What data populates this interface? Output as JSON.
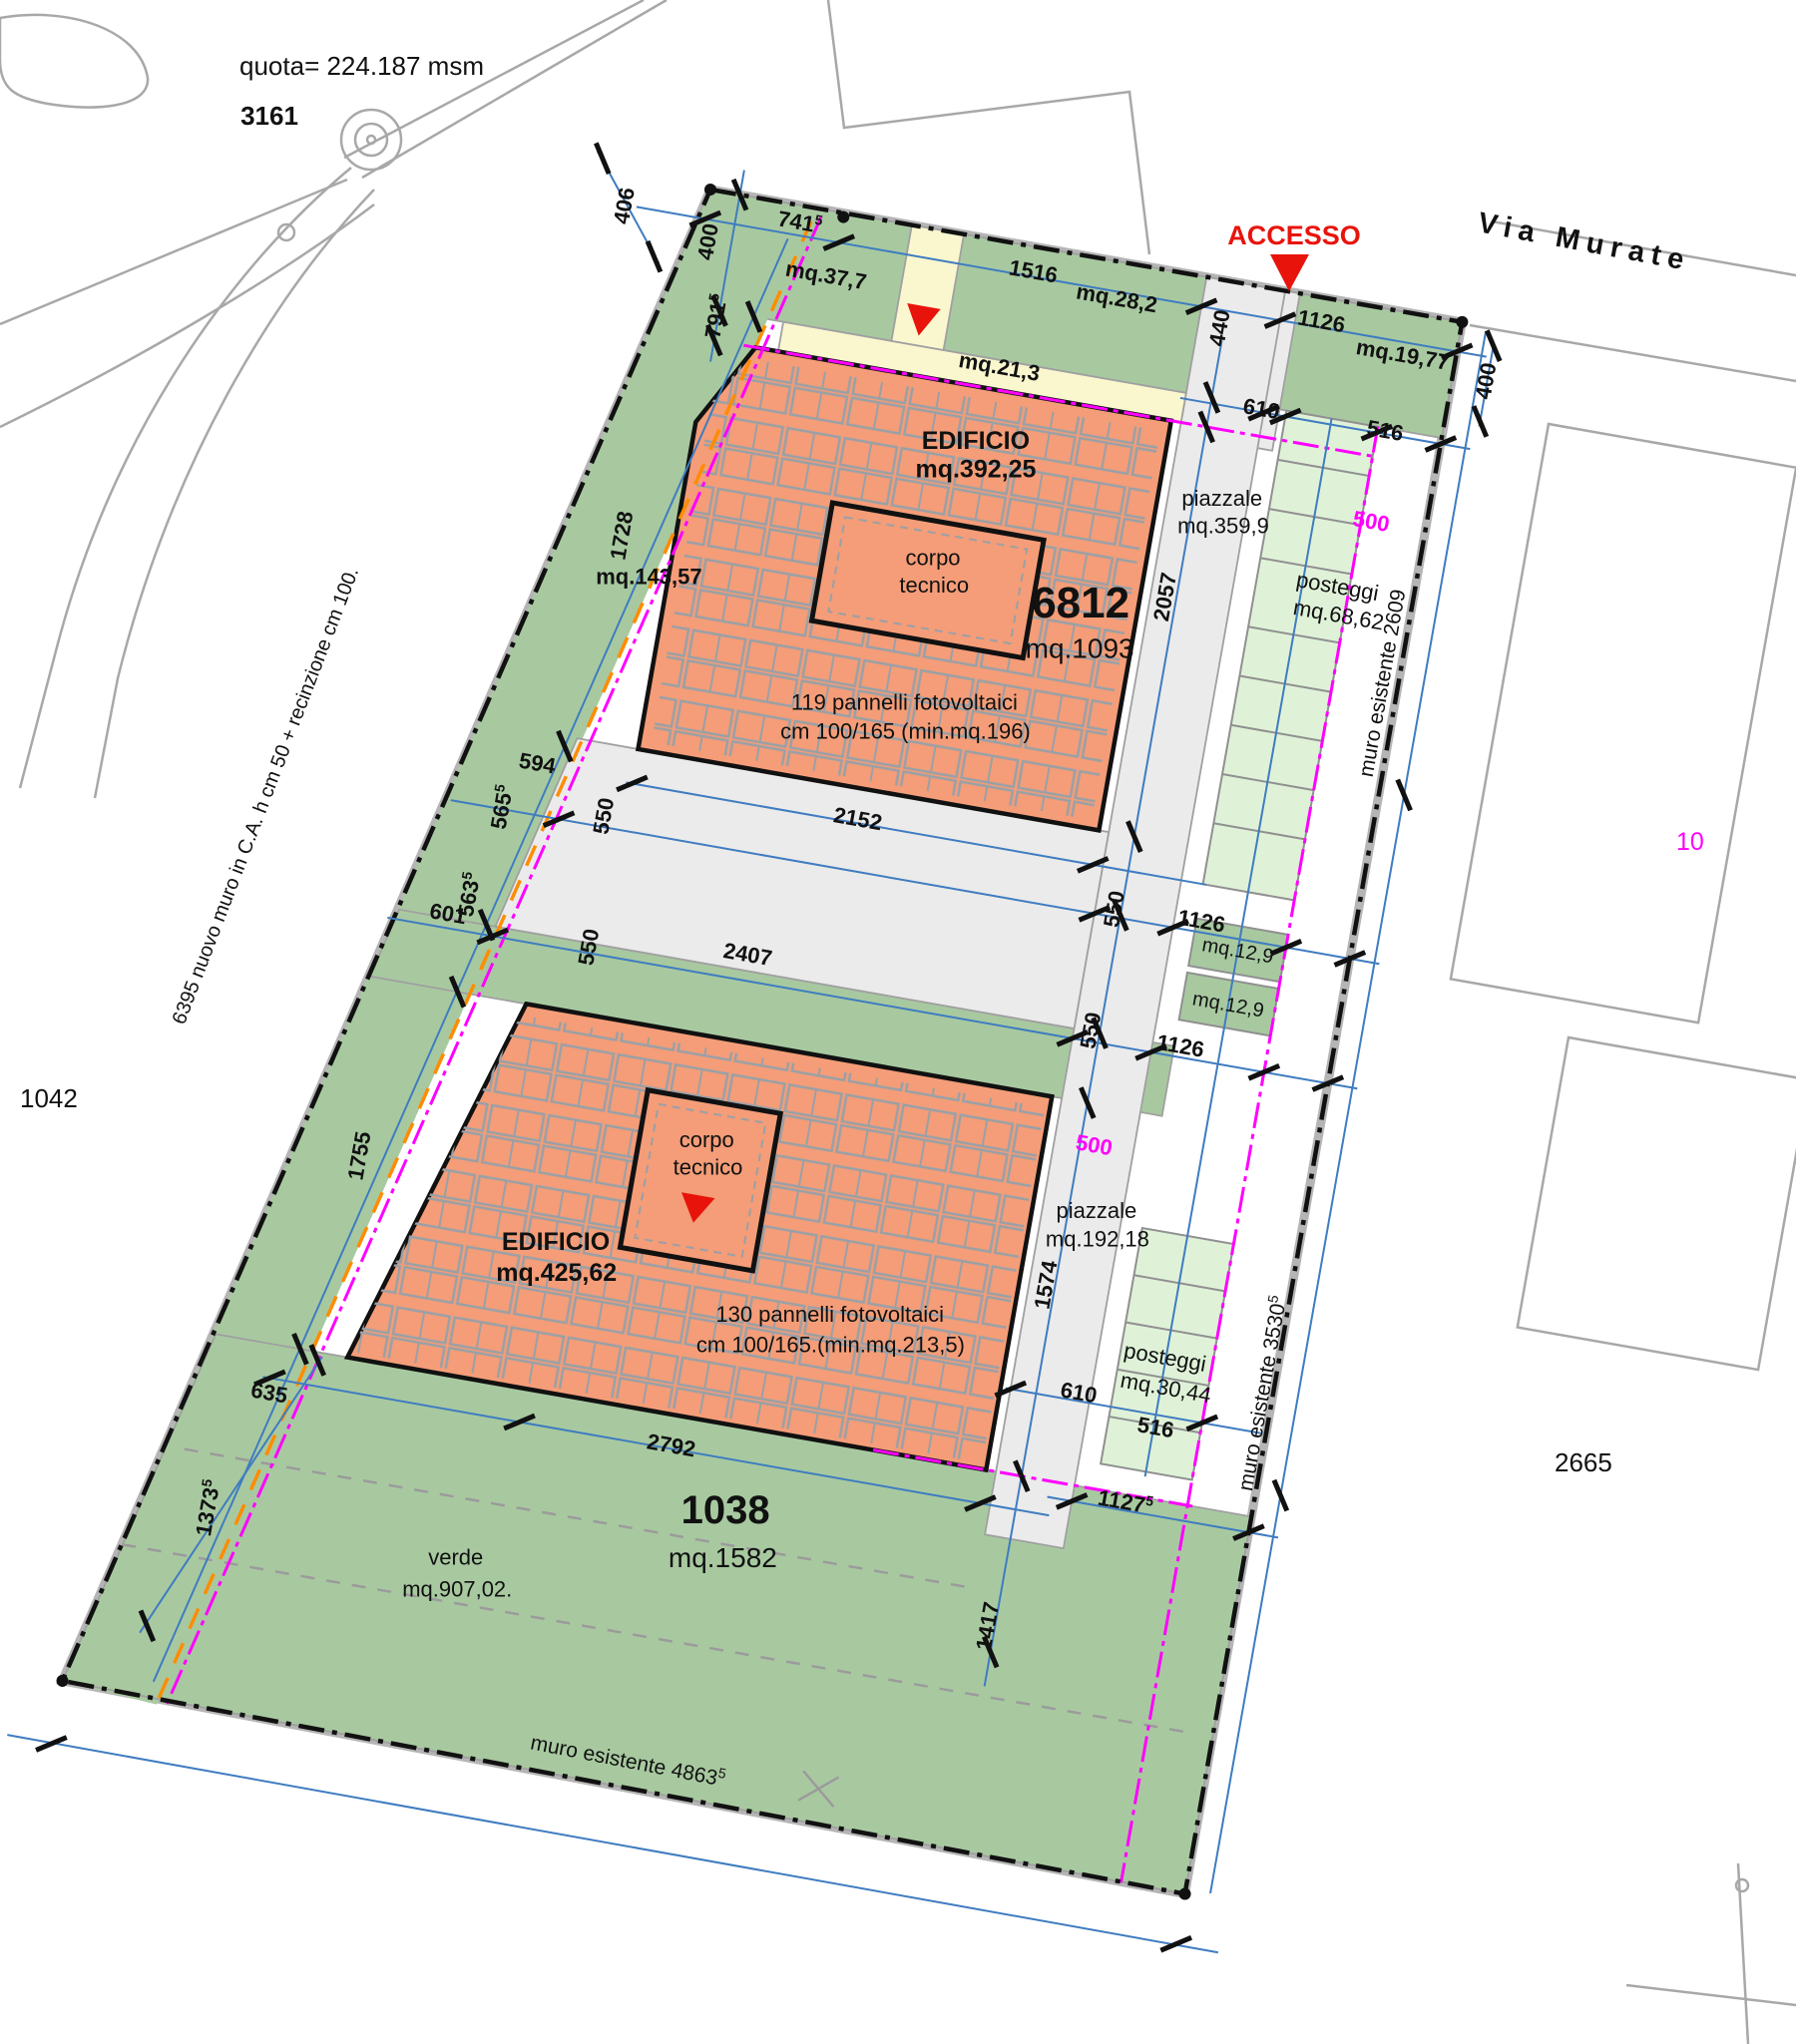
{
  "meta": {
    "quota": "quota= 224.187 msm",
    "benchmark_id": "3161",
    "street": "Via Murate",
    "access": "ACCESSO",
    "parcel_left": "1042",
    "parcel_right": "2665",
    "parcel_magenta": "10"
  },
  "walls": {
    "left": "6395 nuovo muro in C.A. h cm 50 + recinzione cm 100.",
    "right_upper": "muro esistente 2609",
    "right_lower": "muro esistente 3530",
    "right_lower_sup": "5",
    "bottom": "muro esistente 4863",
    "bottom_sup": "5"
  },
  "building1": {
    "title": "EDIFICIO",
    "area": "mq.392,25",
    "parcel_number": "6812",
    "parcel_area": "mq.1093",
    "panels1": "119 pannelli fotovoltaici",
    "panels2": "cm 100/165 (min.mq.196)",
    "corpo1": "corpo",
    "corpo2": "tecnico"
  },
  "building2": {
    "title": "EDIFICIO",
    "area": "mq.425,62",
    "panels1": "130 pannelli fotovoltaici",
    "panels2": "cm 100/165.(min.mq.213,5)",
    "corpo1": "corpo",
    "corpo2": "tecnico"
  },
  "zones": {
    "piazzale1_label": "piazzale",
    "piazzale1_area": "mq.359,9",
    "piazzale2_label": "piazzale",
    "piazzale2_area": "mq.192,18",
    "posteggi1_label": "posteggi",
    "posteggi1_area": "mq.68,62",
    "posteggi2_label": "posteggi",
    "posteggi2_area": "mq.30,44",
    "verde_label": "verde",
    "verde_area": "mq.907,02.",
    "verde_number": "1038",
    "verde_parcel_area": "mq.1582",
    "green_top_left": "mq.37,7",
    "green_top_mid": "mq.28,2",
    "green_top_path": "mq.21,3",
    "green_top_right": "mq.19,77",
    "green_left": "mq.143,57",
    "green_small_1": "mq.12,9",
    "green_small_2": "mq.12,9"
  },
  "dims": {
    "d406": {
      "v": "406"
    },
    "d400_tl": {
      "v": "400"
    },
    "d741": {
      "v": "741",
      "s": "5"
    },
    "d791": {
      "v": "791",
      "s": "5"
    },
    "d1516": {
      "v": "1516"
    },
    "d440": {
      "v": "440"
    },
    "d1126_top": {
      "v": "1126"
    },
    "d400_r": {
      "v": "400"
    },
    "d610_top": {
      "v": "610"
    },
    "d516_top": {
      "v": "516"
    },
    "d500_top": {
      "v": "500"
    },
    "d2057": {
      "v": "2057"
    },
    "d1728": {
      "v": "1728"
    },
    "d2152": {
      "v": "2152"
    },
    "d594": {
      "v": "594"
    },
    "d565": {
      "v": "565",
      "s": "5"
    },
    "d550_a": {
      "v": "550"
    },
    "d550_b": {
      "v": "550"
    },
    "d1126_m1": {
      "v": "1126"
    },
    "d601": {
      "v": "601"
    },
    "d563": {
      "v": "563",
      "s": "5"
    },
    "d550_c": {
      "v": "550"
    },
    "d2407": {
      "v": "2407"
    },
    "d550_d": {
      "v": "550"
    },
    "d1126_m2": {
      "v": "1126"
    },
    "d500_mid": {
      "v": "500"
    },
    "d1755": {
      "v": "1755"
    },
    "d1574": {
      "v": "1574"
    },
    "d635": {
      "v": "635"
    },
    "d2792": {
      "v": "2792"
    },
    "d610_low": {
      "v": "610"
    },
    "d516_low": {
      "v": "516"
    },
    "d1373": {
      "v": "1373",
      "s": "5"
    },
    "d1127": {
      "v": "1127",
      "s": "5"
    },
    "d1417": {
      "v": "1417"
    }
  },
  "colors": {
    "green": "#a8c9a0",
    "pale_green": "#dff2d8",
    "salmon": "#f49d78",
    "cream": "#faf7cf",
    "road_gray": "#ebebeb",
    "dim_blue": "#3f7cc0",
    "magenta": "#ff00ff",
    "orange": "#ff8c00",
    "access_red": "#e8140c",
    "context_gray": "#a8a8a8"
  }
}
